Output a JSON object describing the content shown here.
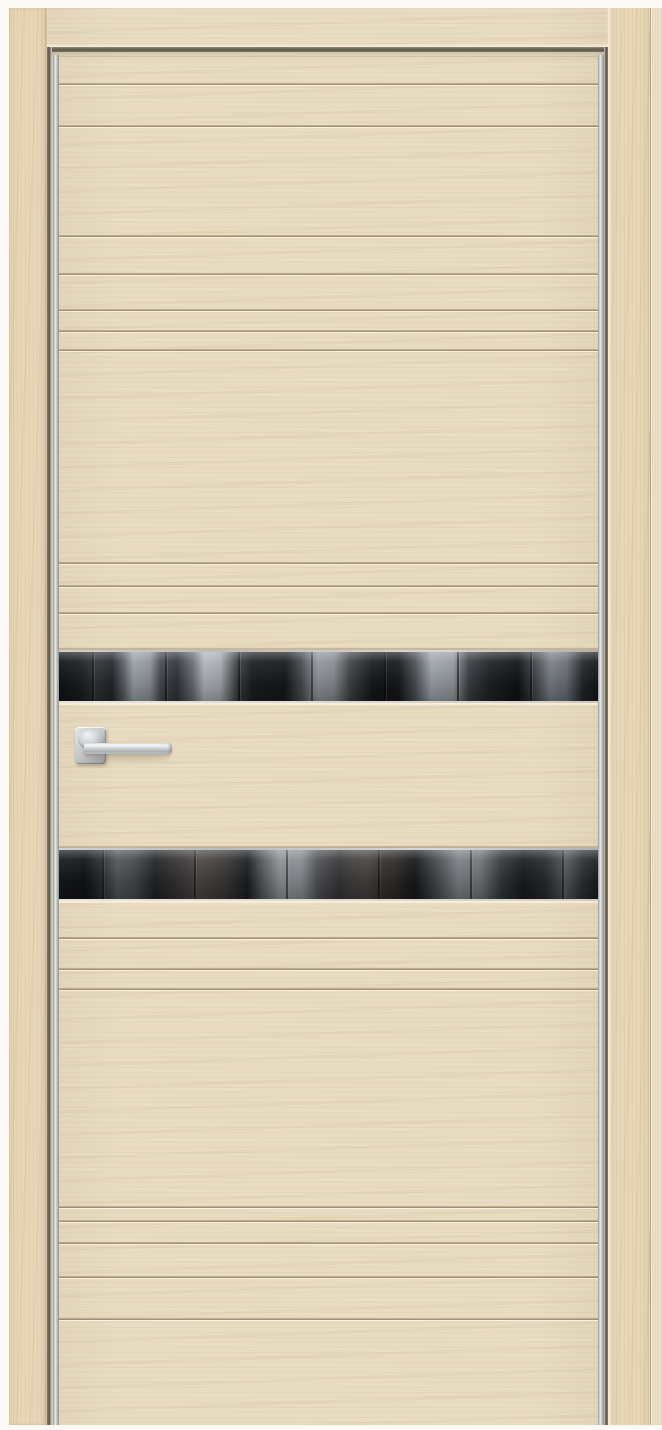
{
  "meta": {
    "image_label": "Modern interior door with light oak finish, horizontal grooves, two smoked-glass inserts and chrome lever handle"
  },
  "colors": {
    "page_bg": "#fbfaf7",
    "leaf_wood": "#e8dbc0",
    "casing_wood": "#e7d6b5",
    "wall_wood": "#ebdfc7",
    "glass_dark": "#141618",
    "chrome": "#c6c9c7",
    "hardware": "#c9cccd"
  },
  "frame": {
    "left_casing_label": "door-frame-casing-left",
    "right_casing_label": "door-frame-casing-right",
    "header_label": "door-frame-header",
    "wall_strip_label": "wall-architrave-right"
  },
  "door": {
    "leaf_label": "door-leaf",
    "grooves_y": [
      83,
      125,
      235,
      273,
      309,
      330,
      349,
      562,
      585,
      612,
      937,
      968,
      988,
      1206,
      1220,
      1242,
      1276,
      1318
    ],
    "glass_inserts": [
      {
        "label": "glass-insert-upper",
        "y": 650,
        "height": 53
      },
      {
        "label": "glass-insert-lower",
        "y": 848,
        "height": 53
      }
    ],
    "handle": {
      "rosette_label": "handle-rosette",
      "lever_label": "handle-lever"
    }
  }
}
